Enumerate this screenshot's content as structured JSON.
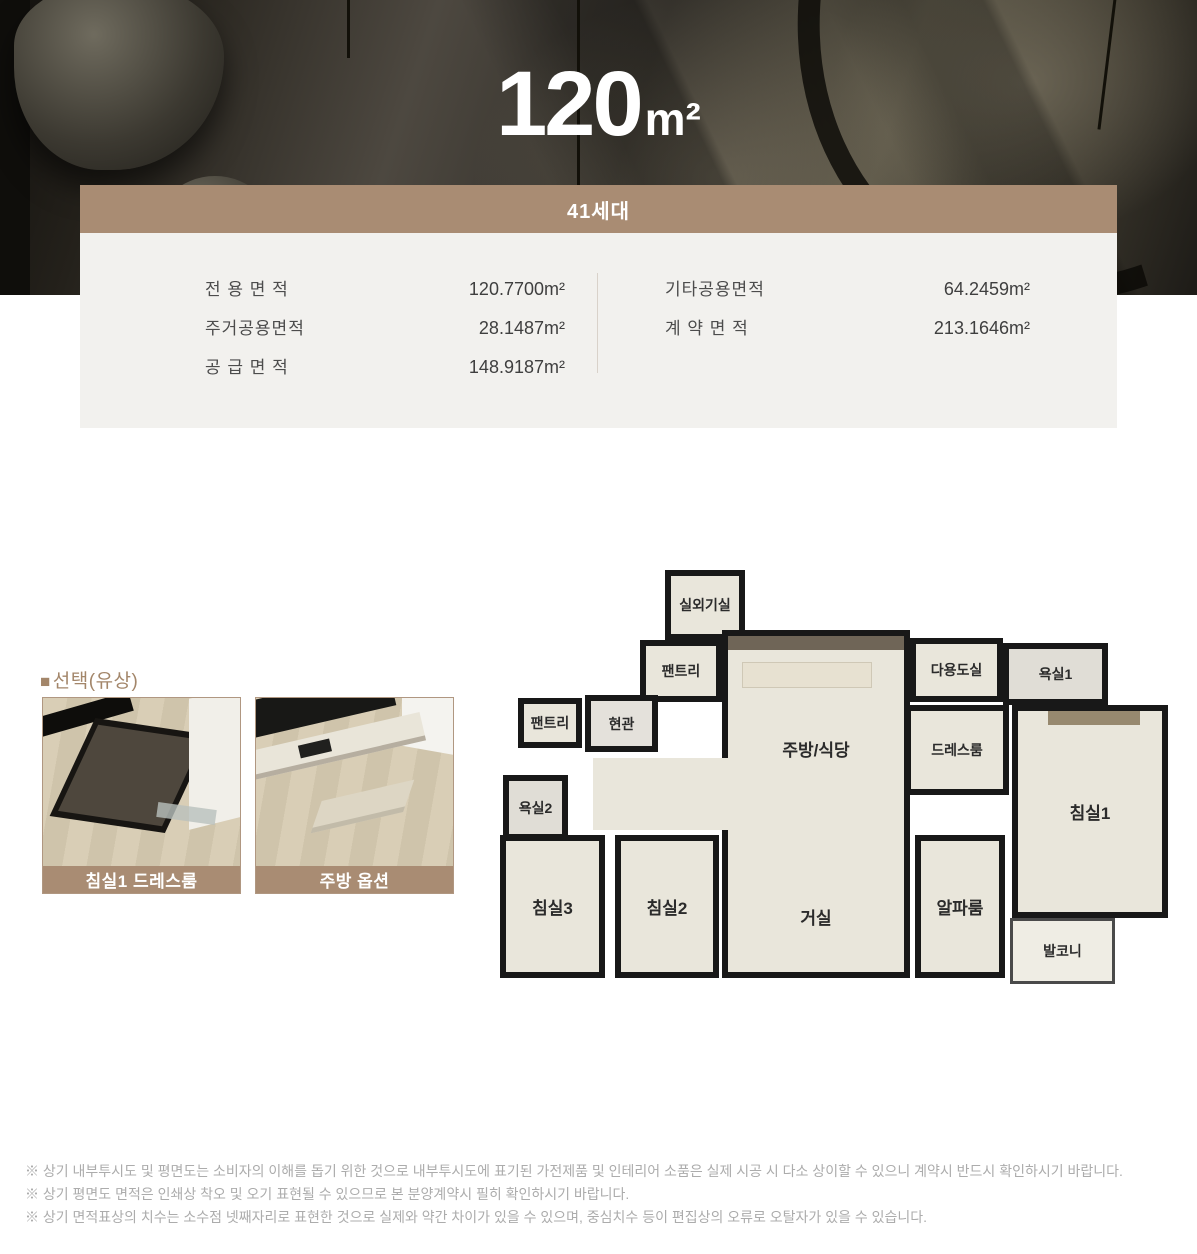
{
  "colors": {
    "accent_brown": "#a98c73"
  },
  "hero": {
    "title_value": "120",
    "title_unit": "m²"
  },
  "banner": {
    "label": "41세대"
  },
  "area_info": {
    "left": [
      {
        "label": "전 용 면 적",
        "value": "120.7700",
        "unit": "m²"
      },
      {
        "label": "주거공용면적",
        "value": "28.1487",
        "unit": "m²"
      },
      {
        "label": "공 급 면 적",
        "value": "148.9187",
        "unit": "m²"
      }
    ],
    "right": [
      {
        "label": "기타공용면적",
        "value": "64.2459",
        "unit": "m²"
      },
      {
        "label": "계 약 면 적",
        "value": "213.1646",
        "unit": "m²"
      }
    ]
  },
  "options": {
    "bullet": "■",
    "heading": "선택(유상)",
    "cards": [
      {
        "caption": "침실1 드레스룸"
      },
      {
        "caption": "주방 옵션"
      }
    ]
  },
  "floorplan": {
    "labels": {
      "outdoor_unit": "실외기실",
      "pantry_top": "팬트리",
      "kitchen_dining": "주방/식당",
      "utility": "다용도실",
      "bath1": "욕실1",
      "pantry_left": "팬트리",
      "entrance": "현관",
      "bath2": "욕실2",
      "dressroom": "드레스룸",
      "bedroom1": "침실1",
      "bedroom2": "침실2",
      "bedroom3": "침실3",
      "living": "거실",
      "alpha_room": "알파룸",
      "balcony": "발코니"
    }
  },
  "disclaimers": [
    "※ 상기 내부투시도 및 평면도는 소비자의 이해를 돕기 위한 것으로 내부투시도에 표기된 가전제품 및 인테리어 소품은 실제 시공 시 다소 상이할 수 있으니 계약시 반드시 확인하시기 바랍니다.",
    "※ 상기 평면도 면적은 인쇄상 착오 및 오기 표현될 수 있으므로 본 분양계약시 필히 확인하시기 바랍니다.",
    "※ 상기 면적표상의 치수는 소수점 넷째자리로 표현한 것으로 실제와 약간 차이가 있을 수 있으며, 중심치수 등이 편집상의 오류로 오탈자가 있을 수 있습니다."
  ]
}
